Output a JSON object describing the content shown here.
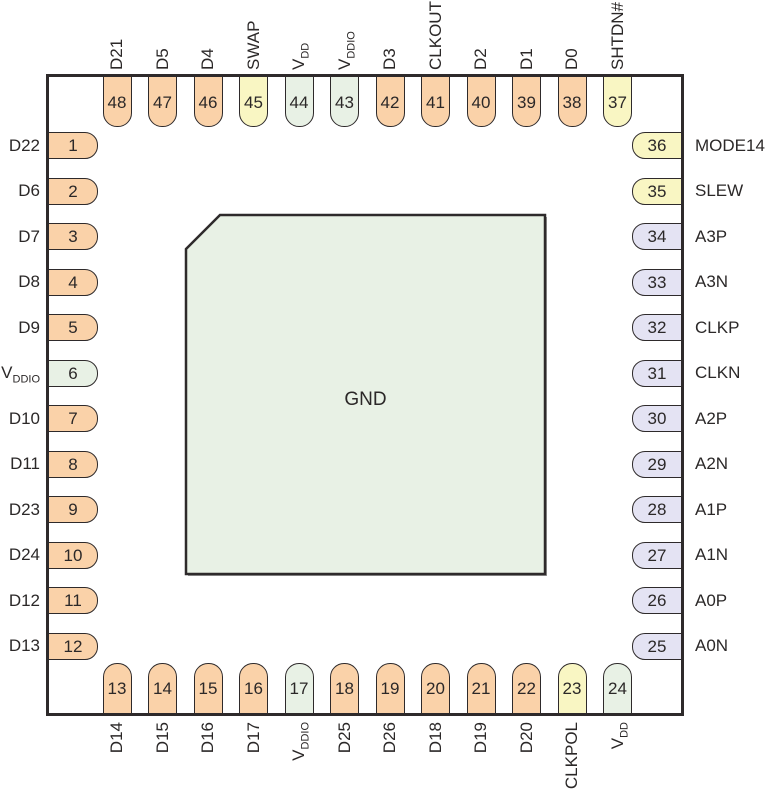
{
  "colors": {
    "digital": "#FAD2A9",
    "control": "#F9F6C3",
    "power": "#E8F1E5",
    "analog": "#E4E3F3",
    "outline": "#2e2a2b",
    "pad_fill": "#E8F1E5",
    "pad_shadow": "#9a9a9a"
  },
  "center_pad": {
    "label": "GND",
    "type": "power"
  },
  "pins": {
    "top": [
      {
        "num": "48",
        "label": "D21",
        "main": "D21",
        "sub": "",
        "type": "digital"
      },
      {
        "num": "47",
        "label": "D5",
        "main": "D5",
        "sub": "",
        "type": "digital"
      },
      {
        "num": "46",
        "label": "D4",
        "main": "D4",
        "sub": "",
        "type": "digital"
      },
      {
        "num": "45",
        "label": "SWAP",
        "main": "SWAP",
        "sub": "",
        "type": "control"
      },
      {
        "num": "44",
        "label": "VDD",
        "main": "V",
        "sub": "DD",
        "type": "power"
      },
      {
        "num": "43",
        "label": "VDDIO",
        "main": "V",
        "sub": "DDIO",
        "type": "power"
      },
      {
        "num": "42",
        "label": "D3",
        "main": "D3",
        "sub": "",
        "type": "digital"
      },
      {
        "num": "41",
        "label": "CLKOUT",
        "main": "CLKOUT",
        "sub": "",
        "type": "digital"
      },
      {
        "num": "40",
        "label": "D2",
        "main": "D2",
        "sub": "",
        "type": "digital"
      },
      {
        "num": "39",
        "label": "D1",
        "main": "D1",
        "sub": "",
        "type": "digital"
      },
      {
        "num": "38",
        "label": "D0",
        "main": "D0",
        "sub": "",
        "type": "digital"
      },
      {
        "num": "37",
        "label": "SHTDN#",
        "main": "SHTDN#",
        "sub": "",
        "type": "control"
      }
    ],
    "left": [
      {
        "num": "1",
        "label": "D22",
        "main": "D22",
        "sub": "",
        "type": "digital"
      },
      {
        "num": "2",
        "label": "D6",
        "main": "D6",
        "sub": "",
        "type": "digital"
      },
      {
        "num": "3",
        "label": "D7",
        "main": "D7",
        "sub": "",
        "type": "digital"
      },
      {
        "num": "4",
        "label": "D8",
        "main": "D8",
        "sub": "",
        "type": "digital"
      },
      {
        "num": "5",
        "label": "D9",
        "main": "D9",
        "sub": "",
        "type": "digital"
      },
      {
        "num": "6",
        "label": "VDDIO",
        "main": "V",
        "sub": "DDIO",
        "type": "power"
      },
      {
        "num": "7",
        "label": "D10",
        "main": "D10",
        "sub": "",
        "type": "digital"
      },
      {
        "num": "8",
        "label": "D11",
        "main": "D11",
        "sub": "",
        "type": "digital"
      },
      {
        "num": "9",
        "label": "D23",
        "main": "D23",
        "sub": "",
        "type": "digital"
      },
      {
        "num": "10",
        "label": "D24",
        "main": "D24",
        "sub": "",
        "type": "digital"
      },
      {
        "num": "11",
        "label": "D12",
        "main": "D12",
        "sub": "",
        "type": "digital"
      },
      {
        "num": "12",
        "label": "D13",
        "main": "D13",
        "sub": "",
        "type": "digital"
      }
    ],
    "right": [
      {
        "num": "36",
        "label": "MODE14",
        "main": "MODE14",
        "sub": "",
        "type": "control"
      },
      {
        "num": "35",
        "label": "SLEW",
        "main": "SLEW",
        "sub": "",
        "type": "control"
      },
      {
        "num": "34",
        "label": "A3P",
        "main": "A3P",
        "sub": "",
        "type": "analog"
      },
      {
        "num": "33",
        "label": "A3N",
        "main": "A3N",
        "sub": "",
        "type": "analog"
      },
      {
        "num": "32",
        "label": "CLKP",
        "main": "CLKP",
        "sub": "",
        "type": "analog"
      },
      {
        "num": "31",
        "label": "CLKN",
        "main": "CLKN",
        "sub": "",
        "type": "analog"
      },
      {
        "num": "30",
        "label": "A2P",
        "main": "A2P",
        "sub": "",
        "type": "analog"
      },
      {
        "num": "29",
        "label": "A2N",
        "main": "A2N",
        "sub": "",
        "type": "analog"
      },
      {
        "num": "28",
        "label": "A1P",
        "main": "A1P",
        "sub": "",
        "type": "analog"
      },
      {
        "num": "27",
        "label": "A1N",
        "main": "A1N",
        "sub": "",
        "type": "analog"
      },
      {
        "num": "26",
        "label": "A0P",
        "main": "A0P",
        "sub": "",
        "type": "analog"
      },
      {
        "num": "25",
        "label": "A0N",
        "main": "A0N",
        "sub": "",
        "type": "analog"
      }
    ],
    "bottom": [
      {
        "num": "13",
        "label": "D14",
        "main": "D14",
        "sub": "",
        "type": "digital"
      },
      {
        "num": "14",
        "label": "D15",
        "main": "D15",
        "sub": "",
        "type": "digital"
      },
      {
        "num": "15",
        "label": "D16",
        "main": "D16",
        "sub": "",
        "type": "digital"
      },
      {
        "num": "16",
        "label": "D17",
        "main": "D17",
        "sub": "",
        "type": "digital"
      },
      {
        "num": "17",
        "label": "VDDIO",
        "main": "V",
        "sub": "DDIO",
        "type": "power"
      },
      {
        "num": "18",
        "label": "D25",
        "main": "D25",
        "sub": "",
        "type": "digital"
      },
      {
        "num": "19",
        "label": "D26",
        "main": "D26",
        "sub": "",
        "type": "digital"
      },
      {
        "num": "20",
        "label": "D18",
        "main": "D18",
        "sub": "",
        "type": "digital"
      },
      {
        "num": "21",
        "label": "D19",
        "main": "D19",
        "sub": "",
        "type": "digital"
      },
      {
        "num": "22",
        "label": "D20",
        "main": "D20",
        "sub": "",
        "type": "digital"
      },
      {
        "num": "23",
        "label": "CLKPOL",
        "main": "CLKPOL",
        "sub": "",
        "type": "control"
      },
      {
        "num": "24",
        "label": "VDD",
        "main": "V",
        "sub": "DD",
        "type": "power"
      }
    ]
  }
}
